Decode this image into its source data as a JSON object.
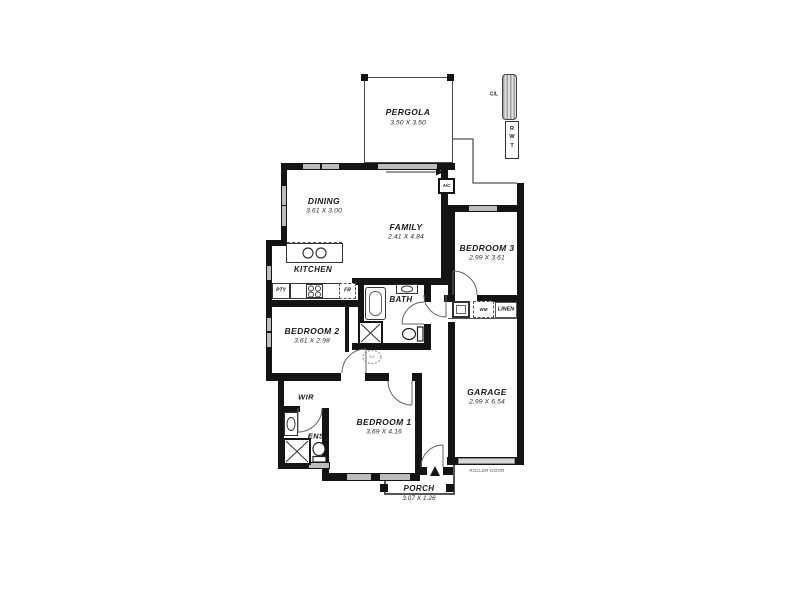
{
  "colors": {
    "wall": "#141414",
    "window": "#bdbdbd",
    "thin_line": "#555555",
    "roller_door_fill": "#d7d7d7",
    "text": "#1a1a1a",
    "background": "#ffffff"
  },
  "rooms": {
    "pergola": {
      "name": "PERGOLA",
      "dims": "3.50 X 3.50"
    },
    "dining": {
      "name": "DINING",
      "dims": "3.61 X 3.00"
    },
    "family": {
      "name": "FAMILY",
      "dims": "2.41 X 4.84"
    },
    "kitchen": {
      "name": "KITCHEN"
    },
    "bedroom3": {
      "name": "BEDROOM 3",
      "dims": "2.99 X 3.61"
    },
    "bedroom2": {
      "name": "BEDROOM 2",
      "dims": "3.61 X 2.98"
    },
    "bedroom1": {
      "name": "BEDROOM 1",
      "dims": "3.69 X 4.16"
    },
    "garage": {
      "name": "GARAGE",
      "dims": "2.99 X 6.54"
    },
    "bath": {
      "name": "BATH"
    },
    "ens": {
      "name": "ENS"
    },
    "wir": {
      "name": "WIR"
    },
    "linen": {
      "name": "LINEN"
    },
    "porch": {
      "name": "PORCH",
      "dims": "3.07 X 1.26"
    }
  },
  "labels": {
    "ac": "A/C",
    "cl": "C/L",
    "rwt": "RWT",
    "pty": "PTY",
    "fridge": "FR",
    "wm": "WM",
    "roller_door": "ROLLER-DOOR",
    "skylight": "S/L"
  }
}
